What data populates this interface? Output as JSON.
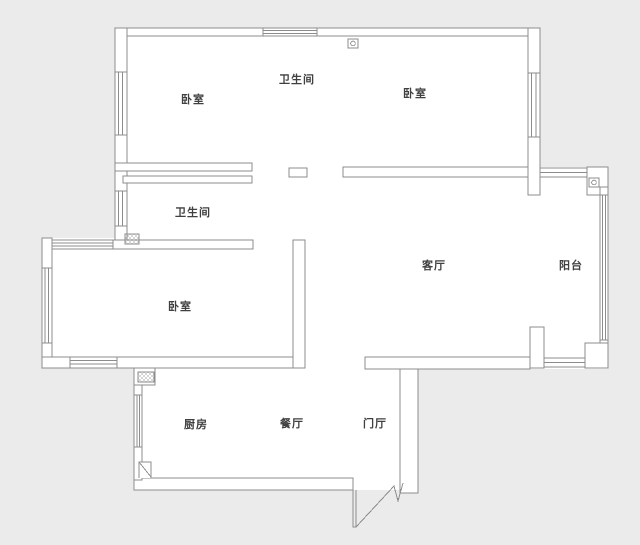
{
  "page": {
    "background": "#ebebeb",
    "floor_fill": "#ffffff",
    "wall_color": "#8c8c8c",
    "label_color": "#404040"
  },
  "rooms": [
    {
      "id": "bedroom-top-left",
      "label": "卧室",
      "cx": 193,
      "cy": 99
    },
    {
      "id": "bathroom-top",
      "label": "卫生间",
      "cx": 297,
      "cy": 79
    },
    {
      "id": "bedroom-top-right",
      "label": "卧室",
      "cx": 415,
      "cy": 93
    },
    {
      "id": "bathroom-middle",
      "label": "卫生间",
      "cx": 193,
      "cy": 212
    },
    {
      "id": "living-room",
      "label": "客厅",
      "cx": 434,
      "cy": 265
    },
    {
      "id": "balcony",
      "label": "阳台",
      "cx": 571,
      "cy": 265
    },
    {
      "id": "bedroom-left",
      "label": "卧室",
      "cx": 180,
      "cy": 306
    },
    {
      "id": "kitchen",
      "label": "厨房",
      "cx": 196,
      "cy": 424
    },
    {
      "id": "dining-room",
      "label": "餐厅",
      "cx": 292,
      "cy": 423
    },
    {
      "id": "foyer",
      "label": "门厅",
      "cx": 375,
      "cy": 423
    }
  ],
  "icons": [
    {
      "name": "flue-hatch-icon",
      "meaning": "duct/flue crosshatch symbol"
    },
    {
      "name": "drain-pipe-icon",
      "meaning": "square with circle drain symbol"
    },
    {
      "name": "entry-door-icon",
      "meaning": "open entrance door zigzag"
    },
    {
      "name": "window-icon",
      "meaning": "multi-line window in wall"
    }
  ]
}
